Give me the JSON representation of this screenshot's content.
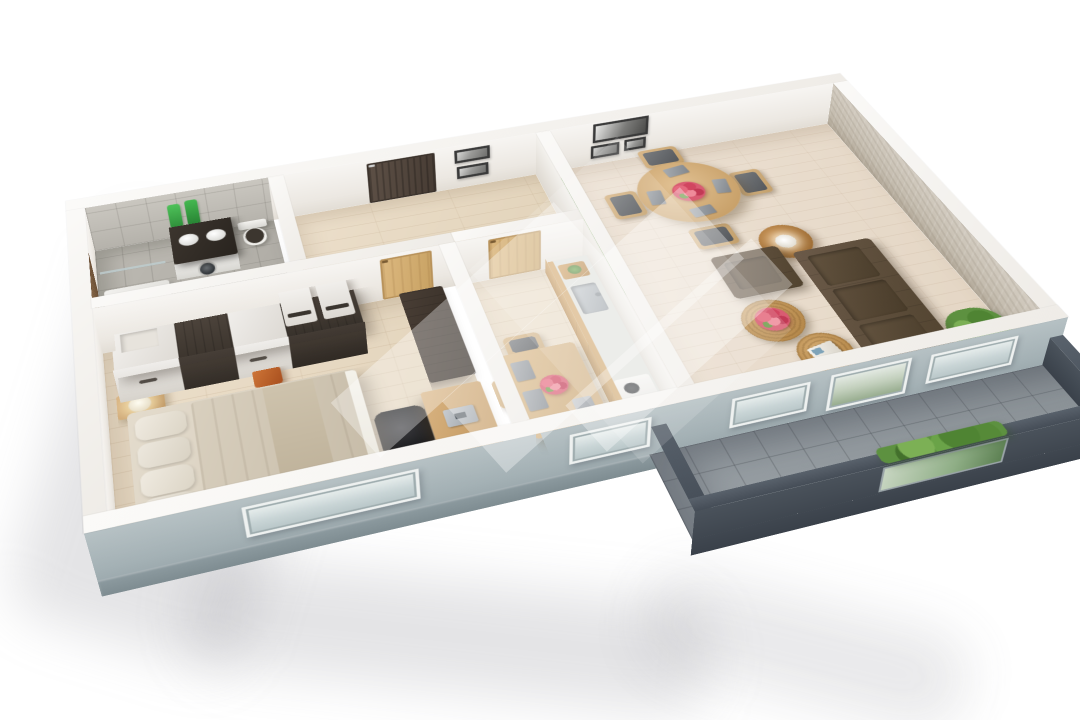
{
  "scene": {
    "title": "3D apartment floor plan render",
    "view": "perspective top-down, rotated",
    "background_color": "#ffffff",
    "watermark": "translucent white diagonal logo stripes over the centre"
  },
  "palette": {
    "exterior_wall": "#a3b0b4",
    "wall_top": "#f7f5f2",
    "interior_wall": "#efece7",
    "balcony_parapet": "#4e5660",
    "balcony_floor": "#939a9f",
    "bathroom_tile": "#b5b2ab",
    "wood_floor": "#e7dac6",
    "living_floor": "#eadfd2",
    "stone_accent_wall": "#c4bcae",
    "sofa_brown": "#5c4c3d",
    "oak_door": "#d2ac72",
    "entry_door": "#54473e",
    "plant_green": "#568a38",
    "flower_pink": "#d95c72",
    "copper_table": "#b07c46"
  },
  "rooms": [
    {
      "id": "bathroom",
      "name": "Bathroom",
      "floor": "grey ceramic tile",
      "furniture": [
        "shower tray",
        "glass screen",
        "dark vanity with twin sinks",
        "washing machine",
        "toilet",
        "green towels",
        "wooden door"
      ]
    },
    {
      "id": "hallway",
      "name": "Hallway",
      "floor": "light oak planks",
      "furniture": [
        "dark entrance door",
        "two framed pictures"
      ]
    },
    {
      "id": "bedroom",
      "name": "Bedroom",
      "floor": "light oak planks",
      "furniture": [
        "wardrobe row",
        "two white cabinets",
        "orange stool",
        "nightstand with lamp",
        "double bed with beige bedding",
        "desk with laptop",
        "black desk chair",
        "dark media cabinet"
      ]
    },
    {
      "id": "kitchen",
      "name": "Kitchen",
      "floor": "light oak planks",
      "furniture": [
        "oak door",
        "counter with sink and hob",
        "dining table",
        "three chairs",
        "grey placemats",
        "flower vase"
      ]
    },
    {
      "id": "living_room",
      "name": "Living room",
      "floor": "light oak planks",
      "furniture": [
        "round dining table",
        "four wooden chairs",
        "pink flower centrepiece",
        "grey placemats",
        "three framed pictures",
        "brown armchair",
        "brown sofa",
        "copper side table with white lamp",
        "two wicker coffee tables",
        "magazine",
        "potted ferns",
        "planter strip"
      ]
    },
    {
      "id": "balcony",
      "name": "Balcony",
      "floor": "grey tile",
      "furniture": [
        "slate parapet",
        "glass planter segment with greenery"
      ]
    }
  ],
  "openings": {
    "windows": [
      "bedroom window",
      "kitchen window",
      "living room window west",
      "living room window east"
    ],
    "doors": [
      "entrance door",
      "bathroom door",
      "bedroom door",
      "kitchen door",
      "balcony glass door"
    ]
  }
}
